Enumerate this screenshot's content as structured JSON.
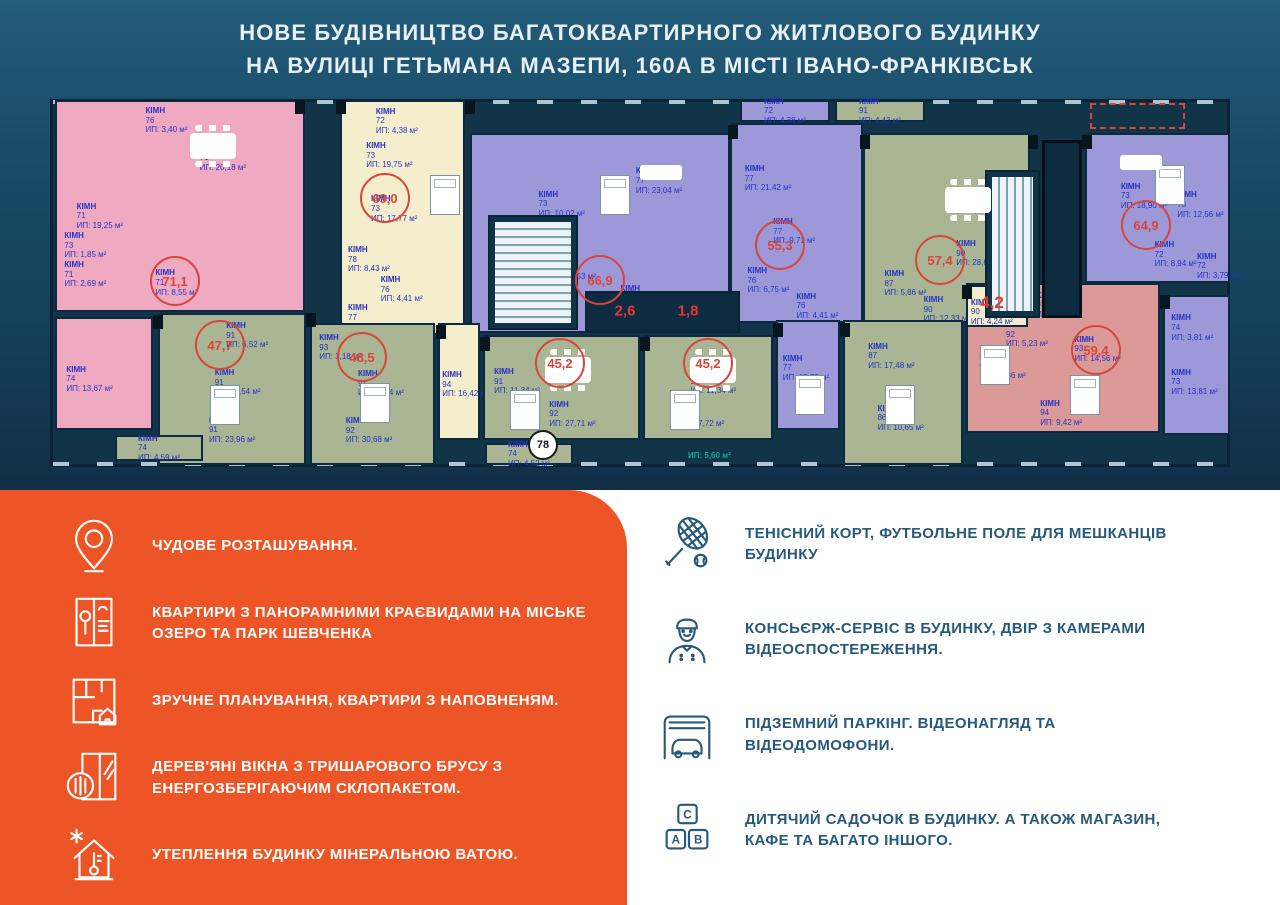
{
  "header": {
    "title_line1": "НОВЕ БУДІВНИЦТВО БАГАТОКВАРТИРНОГО ЖИТЛОВОГО БУДИНКУ",
    "title_line2": "НА ВУЛИЦІ ГЕТЬМАНА МАЗЕПИ, 160А В МІСТІ ІВАНО-ФРАНКІВСЬК"
  },
  "colors": {
    "hero_navy": "#1a4c68",
    "panel_orange": "#ee5526",
    "feature_text_blue": "#26597b",
    "plan_label_blue": "#2433c4",
    "area_badge_red": "#d9453b",
    "unit_pink": "#efa9c1",
    "unit_cream": "#f5eecd",
    "unit_purple": "#9d99d8",
    "unit_green": "#a9b593",
    "unit_salmon": "#db9a98"
  },
  "floor_plan": {
    "labels": {
      "room_word": "КІМН",
      "area_prefix": "ИП:",
      "unit_suffix": "м²"
    },
    "units": [
      {
        "id": "pink-711",
        "color": "pink",
        "x": 15,
        "y": 5,
        "w": 250,
        "h": 212,
        "rooms": [
          {
            "n": "76",
            "a": "3,40",
            "px": 36,
            "py": 2
          },
          {
            "n": "71",
            "a": "20,18",
            "px": 58,
            "py": 20
          },
          {
            "n": "71",
            "a": "19,25",
            "px": 8,
            "py": 48
          },
          {
            "n": "73",
            "a": "1,85",
            "px": 3,
            "py": 62
          },
          {
            "n": "71",
            "a": "2,69",
            "px": 3,
            "py": 76
          },
          {
            "n": "71",
            "a": "8,55",
            "px": 40,
            "py": 80
          }
        ]
      },
      {
        "id": "pink-74",
        "color": "pink",
        "x": 15,
        "y": 222,
        "w": 98,
        "h": 113,
        "rooms": [
          {
            "n": "74",
            "a": "13,67",
            "px": 10,
            "py": 42
          }
        ]
      },
      {
        "id": "cream-690",
        "color": "cream",
        "x": 300,
        "y": 5,
        "w": 125,
        "h": 235,
        "rooms": [
          {
            "n": "72",
            "a": "4,38",
            "px": 28,
            "py": 2
          },
          {
            "n": "73",
            "a": "19,75",
            "px": 20,
            "py": 17
          },
          {
            "n": "73",
            "a": "17,77",
            "px": 24,
            "py": 40
          },
          {
            "n": "78",
            "a": "8,43",
            "px": 5,
            "py": 62
          },
          {
            "n": "76",
            "a": "4,41",
            "px": 32,
            "py": 75
          },
          {
            "n": "77",
            "a": "1,92",
            "px": 5,
            "py": 87
          }
        ]
      },
      {
        "id": "purple-669",
        "color": "purple",
        "x": 430,
        "y": 38,
        "w": 260,
        "h": 200,
        "rooms": [
          {
            "n": "73",
            "a": "10,02",
            "px": 26,
            "py": 28
          },
          {
            "n": "77",
            "a": "23,04",
            "px": 64,
            "py": 16
          },
          {
            "n": "80",
            "a": "1,53",
            "px": 32,
            "py": 60
          },
          {
            "n": "76",
            "a": "9,13",
            "px": 58,
            "py": 76
          },
          {
            "n": "76",
            "a": "4,41",
            "px": 14,
            "py": 80
          }
        ]
      },
      {
        "id": "purple-553",
        "color": "purple",
        "x": 690,
        "y": 28,
        "w": 133,
        "h": 200,
        "rooms": [
          {
            "n": "77",
            "a": "21,42",
            "px": 10,
            "py": 20
          },
          {
            "n": "77",
            "a": "9,71",
            "px": 32,
            "py": 47
          },
          {
            "n": "76",
            "a": "6,75",
            "px": 12,
            "py": 72
          },
          {
            "n": "76",
            "a": "4,41",
            "px": 50,
            "py": 85
          }
        ]
      },
      {
        "id": "green-574",
        "color": "green",
        "x": 823,
        "y": 38,
        "w": 167,
        "h": 190,
        "rooms": [
          {
            "n": "85",
            "a": "12,01",
            "px": 52,
            "py": 28
          },
          {
            "n": "90",
            "a": "28,68",
            "px": 56,
            "py": 56
          },
          {
            "n": "87",
            "a": "5,86",
            "px": 12,
            "py": 72
          },
          {
            "n": "90",
            "a": "12,33",
            "px": 36,
            "py": 86
          }
        ]
      },
      {
        "id": "purple-649",
        "color": "purple",
        "x": 1045,
        "y": 38,
        "w": 145,
        "h": 150,
        "rooms": [
          {
            "n": "73",
            "a": "18,90",
            "px": 24,
            "py": 32
          },
          {
            "n": "73",
            "a": "12,56",
            "px": 64,
            "py": 38
          },
          {
            "n": "72",
            "a": "8,94",
            "px": 48,
            "py": 72
          },
          {
            "n": "72",
            "a": "3,79",
            "px": 78,
            "py": 80
          }
        ]
      },
      {
        "id": "green-477",
        "color": "green",
        "x": 118,
        "y": 218,
        "w": 148,
        "h": 152,
        "rooms": [
          {
            "n": "91",
            "a": "6,52",
            "px": 46,
            "py": 4
          },
          {
            "n": "91",
            "a": "11,54",
            "px": 38,
            "py": 36
          },
          {
            "n": "91",
            "a": "23,96",
            "px": 34,
            "py": 68
          }
        ]
      },
      {
        "id": "green-485",
        "color": "green",
        "x": 270,
        "y": 228,
        "w": 125,
        "h": 142,
        "rooms": [
          {
            "n": "93",
            "a": "3,18",
            "px": 6,
            "py": 6
          },
          {
            "n": "91",
            "a": "11,34",
            "px": 38,
            "py": 32
          },
          {
            "n": "92",
            "a": "30,68",
            "px": 28,
            "py": 66
          }
        ]
      },
      {
        "id": "cream-94",
        "color": "cream",
        "x": 398,
        "y": 228,
        "w": 42,
        "h": 117,
        "rooms": [
          {
            "n": "94",
            "a": "16,42",
            "px": 6,
            "py": 40
          }
        ]
      },
      {
        "id": "green-452a",
        "color": "green",
        "x": 443,
        "y": 240,
        "w": 157,
        "h": 105,
        "rooms": [
          {
            "n": "91",
            "a": "11,34",
            "px": 6,
            "py": 30
          },
          {
            "n": "92",
            "a": "27,71",
            "px": 42,
            "py": 62
          }
        ]
      },
      {
        "id": "green-452b",
        "color": "green",
        "x": 603,
        "y": 240,
        "w": 130,
        "h": 105,
        "rooms": [
          {
            "n": "91",
            "a": "11,34",
            "px": 36,
            "py": 30
          },
          {
            "n": "92",
            "a": "27,72",
            "px": 26,
            "py": 62
          }
        ]
      },
      {
        "id": "purple-mid",
        "color": "purple",
        "x": 736,
        "y": 225,
        "w": 64,
        "h": 110,
        "rooms": [
          {
            "n": "77",
            "a": "15,73",
            "px": 8,
            "py": 30
          }
        ]
      },
      {
        "id": "green-574-lower",
        "color": "green",
        "x": 803,
        "y": 225,
        "w": 120,
        "h": 145,
        "rooms": [
          {
            "n": "87",
            "a": "17,48",
            "px": 20,
            "py": 14
          },
          {
            "n": "86",
            "a": "10,65",
            "px": 28,
            "py": 58
          }
        ]
      },
      {
        "id": "salmon-594",
        "color": "salmon",
        "x": 926,
        "y": 188,
        "w": 194,
        "h": 150,
        "rooms": [
          {
            "n": "93",
            "a": "9,13",
            "px": 36,
            "py": 4
          },
          {
            "n": "92",
            "a": "5,23",
            "px": 20,
            "py": 24
          },
          {
            "n": "93",
            "a": "14,56",
            "px": 56,
            "py": 34
          },
          {
            "n": "90",
            "a": "13,36",
            "px": 6,
            "py": 46
          },
          {
            "n": "94",
            "a": "9,42",
            "px": 38,
            "py": 78
          }
        ]
      },
      {
        "id": "cream-42",
        "color": "cream",
        "x": 926,
        "y": 190,
        "w": 62,
        "h": 42,
        "rooms": [
          {
            "n": "90",
            "a": "4,24",
            "px": 5,
            "py": 28
          }
        ]
      },
      {
        "id": "purple-right-lower",
        "color": "purple",
        "x": 1123,
        "y": 200,
        "w": 67,
        "h": 140,
        "rooms": [
          {
            "n": "74",
            "a": "3,81",
            "px": 10,
            "py": 12
          },
          {
            "n": "73",
            "a": "13,81",
            "px": 10,
            "py": 52
          }
        ]
      }
    ],
    "tabs": [
      {
        "n": "72",
        "a": "4,38",
        "x": 700,
        "y": 5,
        "w": 90,
        "h": 22,
        "color": "purple"
      },
      {
        "n": "91",
        "a": "4,43",
        "x": 795,
        "y": 5,
        "w": 90,
        "h": 22,
        "color": "green"
      },
      {
        "n": "74",
        "a": "4,59",
        "x": 75,
        "y": 340,
        "w": 88,
        "h": 26,
        "color": "green"
      },
      {
        "n": "74",
        "a": "4,52",
        "x": 445,
        "y": 348,
        "w": 88,
        "h": 22,
        "color": "green"
      }
    ],
    "badges": [
      {
        "v": "71,1",
        "x": 135,
        "y": 186,
        "type": "circle"
      },
      {
        "v": "69,0",
        "x": 345,
        "y": 103,
        "type": "circle"
      },
      {
        "v": "66,9",
        "x": 560,
        "y": 185,
        "type": "circle"
      },
      {
        "v": "47,7",
        "x": 180,
        "y": 250,
        "type": "circle"
      },
      {
        "v": "48,5",
        "x": 322,
        "y": 262,
        "type": "circle"
      },
      {
        "v": "45,2",
        "x": 520,
        "y": 268,
        "type": "circle"
      },
      {
        "v": "45,2",
        "x": 668,
        "y": 268,
        "type": "circle"
      },
      {
        "v": "55,3",
        "x": 740,
        "y": 150,
        "type": "circle"
      },
      {
        "v": "57,4",
        "x": 900,
        "y": 165,
        "type": "circle"
      },
      {
        "v": "59,4",
        "x": 1056,
        "y": 255,
        "type": "circle"
      },
      {
        "v": "64,9",
        "x": 1106,
        "y": 130,
        "type": "circle"
      },
      {
        "v": "4,2",
        "x": 952,
        "y": 208,
        "type": "plain-lg"
      },
      {
        "v": "2,6",
        "x": 585,
        "y": 216,
        "type": "plain"
      },
      {
        "v": "1,8",
        "x": 648,
        "y": 216,
        "type": "plain"
      },
      {
        "v": "78",
        "x": 503,
        "y": 350,
        "type": "dark"
      }
    ],
    "cores": [
      {
        "x": 448,
        "y": 120,
        "w": 90,
        "h": 115,
        "dir": "h"
      },
      {
        "x": 945,
        "y": 75,
        "w": 55,
        "h": 148,
        "dir": "v"
      }
    ],
    "elevator": {
      "x": 1002,
      "y": 45,
      "w": 40,
      "h": 178
    },
    "balcony_dark": {
      "x": 545,
      "y": 196,
      "w": 155,
      "h": 42
    },
    "dashed_terrace": {
      "x": 1050,
      "y": 8,
      "w": 95,
      "h": 26
    },
    "floating_labels": [
      {
        "text": "ИП: 5,60 м²",
        "x": 648,
        "y": 356,
        "color": "#1fa39a"
      }
    ],
    "piers": [
      [
        255,
        5
      ],
      [
        296,
        5
      ],
      [
        425,
        5
      ],
      [
        688,
        30
      ],
      [
        820,
        40
      ],
      [
        988,
        40
      ],
      [
        1042,
        40
      ],
      [
        113,
        220
      ],
      [
        266,
        218
      ],
      [
        396,
        230
      ],
      [
        440,
        242
      ],
      [
        600,
        242
      ],
      [
        733,
        228
      ],
      [
        800,
        228
      ],
      [
        922,
        190
      ],
      [
        1120,
        200
      ]
    ],
    "furniture": {
      "tables": [
        [
          505,
          262
        ],
        [
          650,
          262
        ],
        [
          150,
          38
        ],
        [
          905,
          92
        ]
      ],
      "beds": [
        [
          170,
          290
        ],
        [
          320,
          288
        ],
        [
          470,
          295
        ],
        [
          630,
          295
        ],
        [
          755,
          280
        ],
        [
          845,
          290
        ],
        [
          1030,
          280
        ],
        [
          390,
          80
        ],
        [
          560,
          80
        ],
        [
          1115,
          70
        ],
        [
          940,
          250
        ]
      ],
      "sofas": [
        [
          600,
          70
        ],
        [
          1080,
          60
        ]
      ]
    }
  },
  "features_left": {
    "items": [
      {
        "icon": "location-pin",
        "text": "ЧУДОВЕ РОЗТАШУВАННЯ."
      },
      {
        "icon": "panoramic-window",
        "text": "КВАРТИРИ З ПАНОРАМНИМИ КРАЄВИДАМИ НА МІСЬКЕ ОЗЕРО ТА ПАРК ШЕВЧЕНКА"
      },
      {
        "icon": "floor-plan",
        "text": "ЗРУЧНЕ ПЛАНУВАННЯ, КВАРТИРИ З НАПОВНЕНЯМ."
      },
      {
        "icon": "wooden-window",
        "text": "ДЕРЕВ'ЯНІ ВІКНА З ТРИШАРОВОГО БРУСУ З ЕНЕРГОЗБЕРІГАЮЧИМ СКЛОПАКЕТОМ."
      },
      {
        "icon": "insulated-house",
        "text": "УТЕПЛЕННЯ БУДИНКУ МІНЕРАЛЬНОЮ ВАТОЮ."
      }
    ]
  },
  "features_right": {
    "items": [
      {
        "icon": "tennis-racket",
        "text": "ТЕНІСНИЙ КОРТ, ФУТБОЛЬНЕ ПОЛЕ ДЛЯ МЕШКАНЦІВ БУДИНКУ"
      },
      {
        "icon": "concierge",
        "text": "КОНСЬЄРЖ-СЕРВІС В БУДИНКУ, ДВІР З КАМЕРАМИ ВІДЕОСПОСТЕРЕЖЕННЯ."
      },
      {
        "icon": "garage",
        "text": "ПІДЗЕМНИЙ ПАРКІНГ. ВІДЕОНАГЛЯД ТА ВІДЕОДОМОФОНИ."
      },
      {
        "icon": "abc-blocks",
        "text": "ДИТЯЧИЙ САДОЧОК В БУДИНКУ. А ТАКОЖ МАГАЗИН, КАФЕ ТА БАГАТО ІНШОГО."
      }
    ]
  },
  "icons": {
    "blocks_letters": [
      "С",
      "А",
      "В"
    ]
  }
}
